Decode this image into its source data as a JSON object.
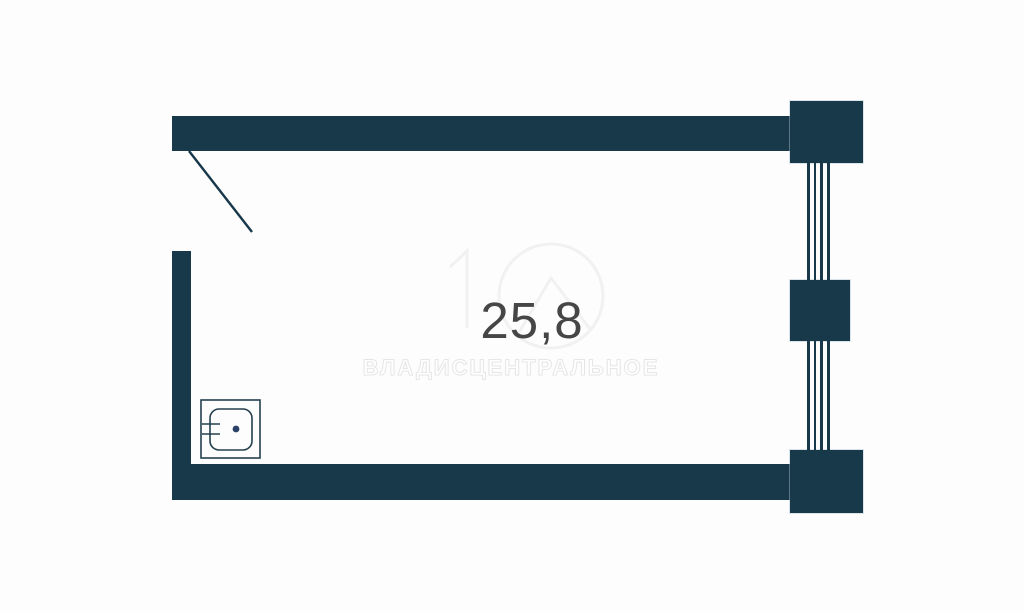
{
  "floorplan": {
    "area_value": "25,8",
    "watermark_text": "ВЛАДИСЦЕНТРАЛЬНОЕ",
    "icons": {
      "sink": "sink-icon"
    },
    "colors": {
      "background": "#fdfdfd",
      "wall": "#17394a",
      "door_line": "#16384a",
      "area_text": "#464646",
      "sink_stroke": "#24404f",
      "sink_dot": "#2a4168",
      "watermark_stroke": "#f1f1f1"
    }
  }
}
